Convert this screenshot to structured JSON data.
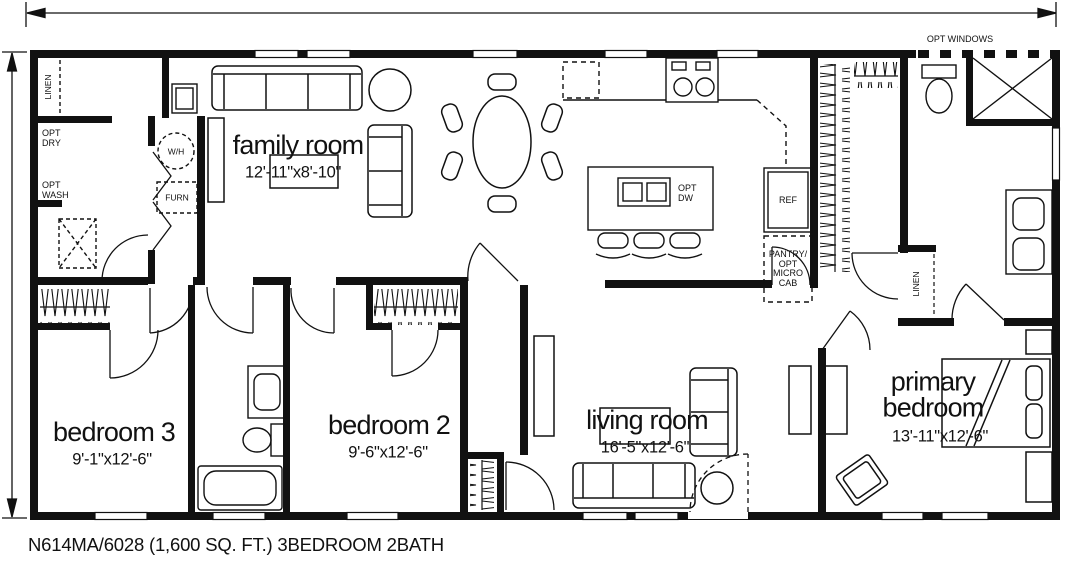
{
  "plan": {
    "footer": "N614MA/6028 (1,600 SQ. FT.) 3BEDROOM 2BATH"
  },
  "rooms": {
    "family_room": {
      "name": "family room",
      "dims": "12'-11\"x8'-10\""
    },
    "bedroom_3": {
      "name": "bedroom 3",
      "dims": "9'-1\"x12'-6\""
    },
    "bedroom_2": {
      "name": "bedroom 2",
      "dims": "9'-6\"x12'-6\""
    },
    "living_room": {
      "name": "living room",
      "dims": "16'-5\"x12'-6\""
    },
    "primary_bedroom": {
      "name": "primary bedroom",
      "dims": "13'-11\"x12'-6\""
    }
  },
  "fixtures": {
    "linen_utility": "LINEN",
    "linen_bath": "LINEN",
    "opt_dry": "OPT\nDRY",
    "opt_wash": "OPT\nWASH",
    "water_heater": "W/H",
    "furnace": "FURN",
    "refrigerator": "REF",
    "pantry": "PANTRY/\nOPT\nMICRO\nCAB",
    "opt_dishwasher": "OPT\nDW",
    "opt_windows": "OPT WINDOWS"
  },
  "colors": {
    "ink": "#111111",
    "bg": "#ffffff"
  }
}
